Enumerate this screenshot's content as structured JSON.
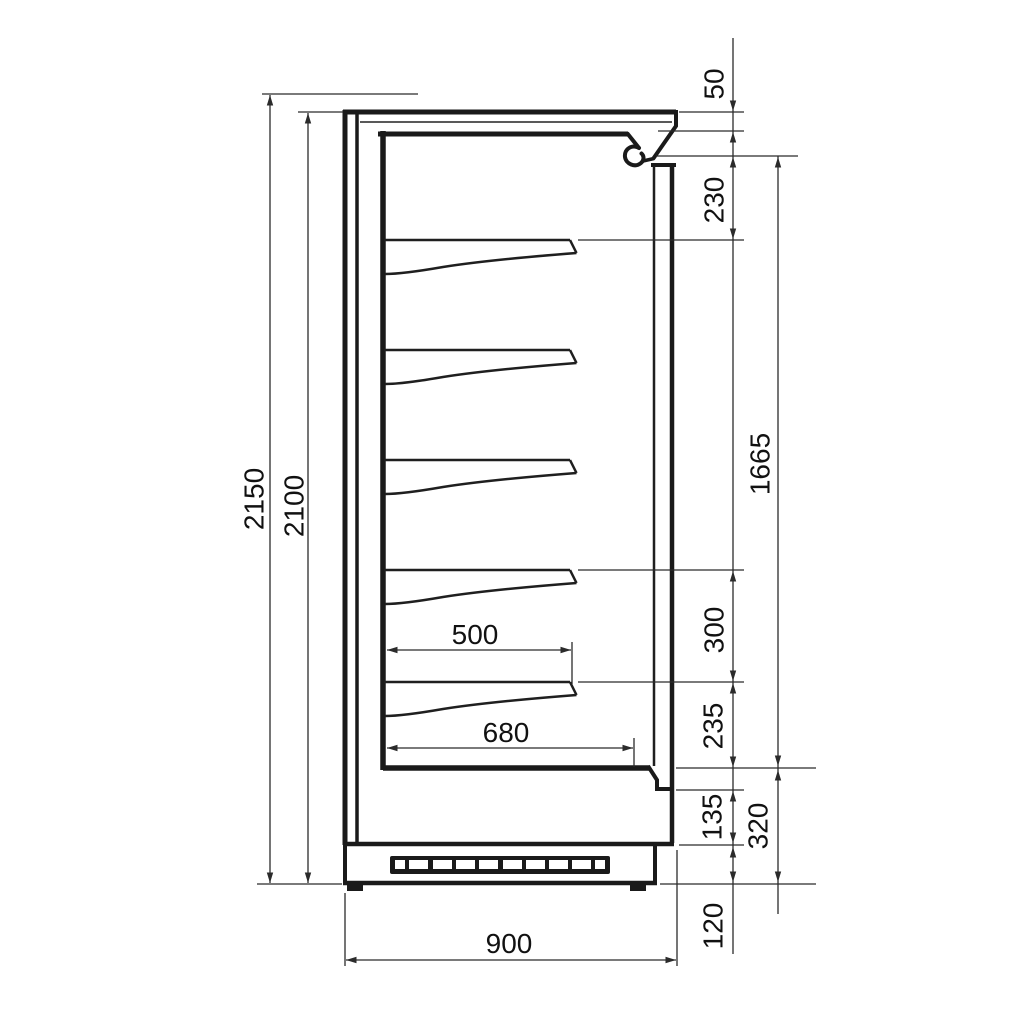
{
  "diagram": {
    "description": "Dimensioned side-section technical drawing of a multideck refrigerated display cabinet with five shelves, ventilation grille plinth and dimension chains",
    "units_note": "",
    "labels": {
      "overall_height": "2150",
      "height_without_top": "2100",
      "top_panel": "50",
      "first_shelf_offset": "230",
      "display_opening": "1665",
      "shelf_spacing": "300",
      "bottom_shelf_offset": "235",
      "lower_front_panel": "135",
      "base_section": "320",
      "plinth": "120",
      "shelf_depth": "500",
      "bottom_deck_depth": "680",
      "overall_depth": "900"
    }
  }
}
